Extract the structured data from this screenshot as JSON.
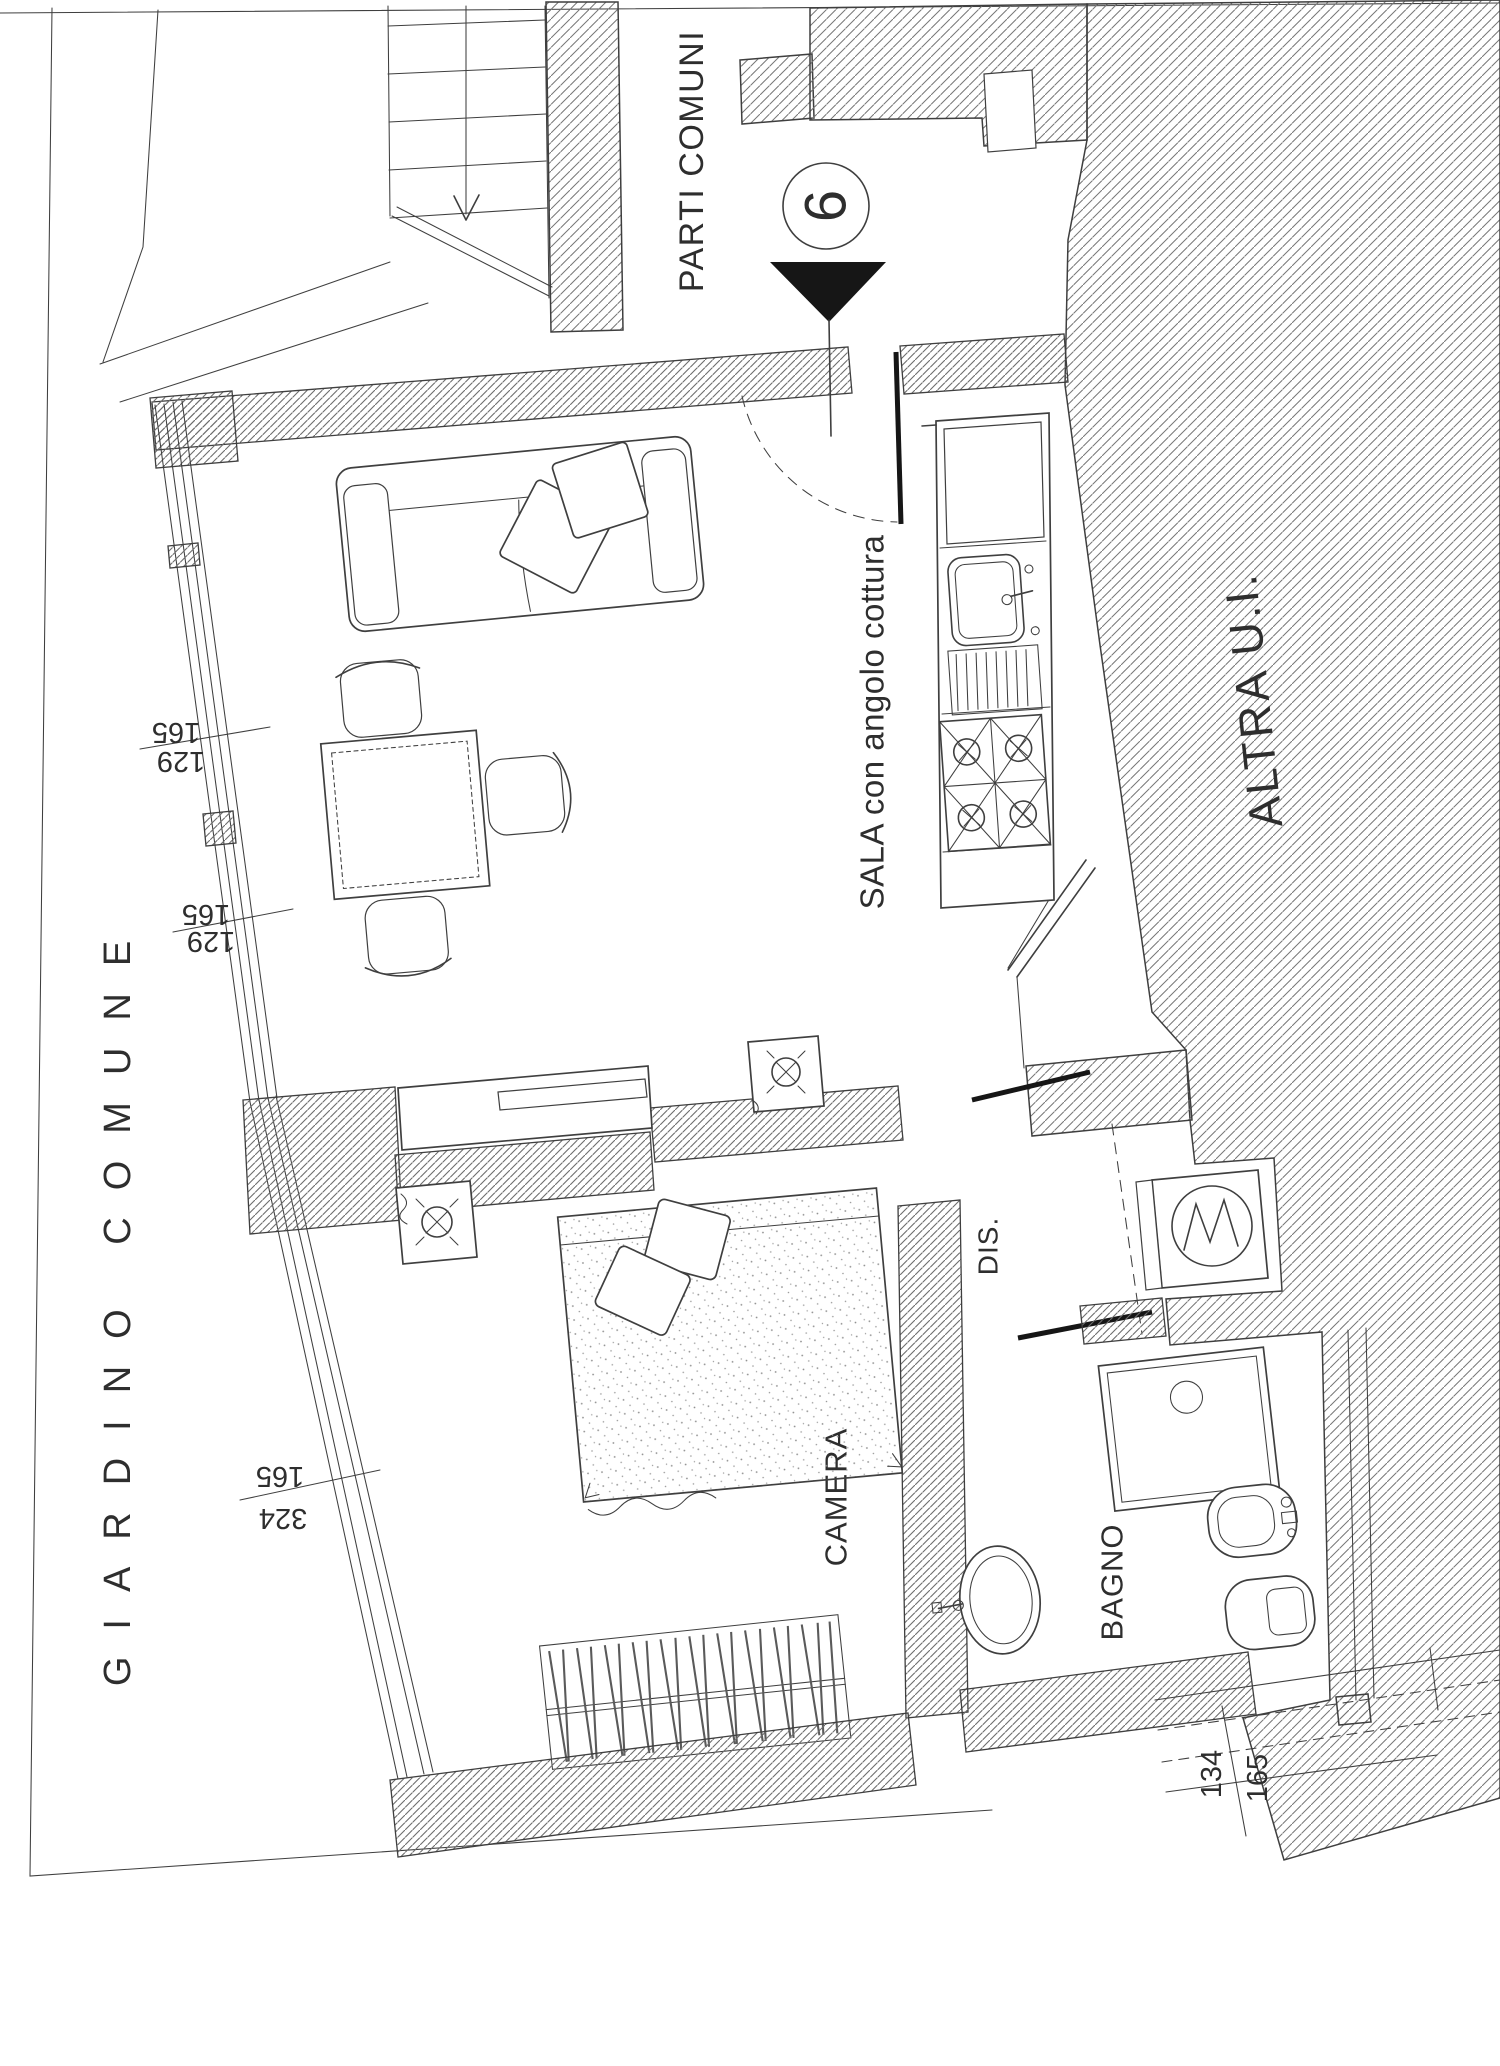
{
  "colors": {
    "paper": "#ffffff",
    "ink": "#3f3f3f",
    "ink-dark": "#161616",
    "text": "#2e2e2e"
  },
  "labels": {
    "common_parts": "PARTI COMUNI",
    "garden": "GIARDINO COMUNE",
    "other_unit": "ALTRA U.I.",
    "living": "SALA con angolo cottura",
    "bedroom": "CAMERA",
    "bathroom": "BAGNO",
    "hall": "DIS.",
    "unit_number": "6"
  },
  "dimensions": {
    "sala_window_1": {
      "line1": "165",
      "line2": "129"
    },
    "sala_window_2": {
      "line1": "165",
      "line2": "129"
    },
    "camera_window": {
      "line1": "165",
      "line2": "324"
    },
    "bagno_window": {
      "line1": "134",
      "line2": "165"
    }
  }
}
